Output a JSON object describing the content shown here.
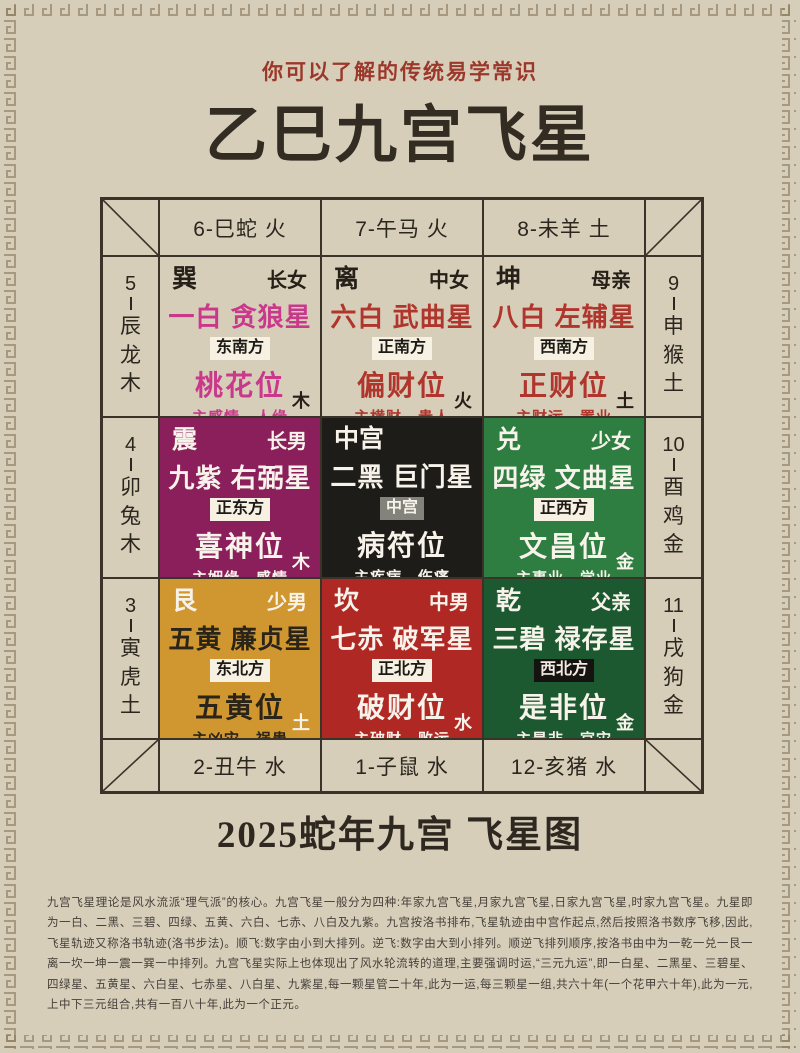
{
  "header": {
    "subtitle": "你可以了解的传统易学常识",
    "title": "乙巳九宫飞星"
  },
  "footer": {
    "caption": "2025蛇年九宫 飞星图",
    "paragraph": "九宫飞星理论是风水流派“理气派”的核心。九宫飞星一般分为四种:年家九宫飞星,月家九宫飞星,日家九宫飞星,时家九宫飞星。九星即为一白、二黑、三碧、四绿、五黄、六白、七赤、八白及九紫。九宫按洛书排布,飞星轨迹由中宫作起点,然后按照洛书数序飞移,因此,飞星轨迹又称洛书轨迹(洛书步法)。顺飞:数字由小到大排列。逆飞:数字由大到小排列。顺逆飞排列顺序,按洛书由中为一乾一兑一艮一离一坎一坤一震一巽一中排列。九宫飞星实际上也体现出了风水轮流转的道理,主要强调时运,“三元九运”,即一白星、二黑星、三碧星、四绿星、五黄星、六白星、七赤星、八白星、九紫星,每一颗星管二十年,此为一运,每三颗星一组,共六十年(一个花甲六十年),此为一元,上中下三元组合,共有一百八十年,此为一个正元。"
  },
  "palette": {
    "paper": "#d7ceba",
    "line": "#3a332a",
    "subtitle_red": "#9c382b",
    "title_ink": "#332c22",
    "meander": "#8d7c60"
  },
  "zodiac": {
    "top": [
      "6-巳蛇 火",
      "7-午马 火",
      "8-未羊 土"
    ],
    "bottom": [
      "2-丑牛 水",
      "1-子鼠 水",
      "12-亥猪 水"
    ],
    "left": [
      {
        "num": "5",
        "name": "辰龙木"
      },
      {
        "num": "4",
        "name": "卯兔木"
      },
      {
        "num": "3",
        "name": "寅虎土"
      }
    ],
    "right": [
      {
        "num": "9",
        "name": "申猴土"
      },
      {
        "num": "10",
        "name": "酉鸡金"
      },
      {
        "num": "11",
        "name": "戌狗金"
      }
    ]
  },
  "cells": [
    {
      "trigram": "巽",
      "relation": "长女",
      "star": "一白 贪狼星",
      "direction": "东南方",
      "position": "桃花位",
      "meaning": "主感情、人缘",
      "element": "木",
      "bg": "transparent",
      "header_fg": "#262019",
      "star_fg": "#c9388b",
      "badge_bg": "#f6f1e3",
      "badge_fg": "#1d1a15",
      "element_fg": "#262019"
    },
    {
      "trigram": "离",
      "relation": "中女",
      "star": "六白 武曲星",
      "direction": "正南方",
      "position": "偏财位",
      "meaning": "主横财、贵人",
      "element": "火",
      "bg": "transparent",
      "header_fg": "#262019",
      "star_fg": "#b0352c",
      "badge_bg": "#f6f1e3",
      "badge_fg": "#1d1a15",
      "element_fg": "#262019"
    },
    {
      "trigram": "坤",
      "relation": "母亲",
      "star": "八白 左辅星",
      "direction": "西南方",
      "position": "正财位",
      "meaning": "主财运、置业",
      "element": "土",
      "bg": "transparent",
      "header_fg": "#262019",
      "star_fg": "#b0352c",
      "badge_bg": "#f6f1e3",
      "badge_fg": "#1d1a15",
      "element_fg": "#262019"
    },
    {
      "trigram": "震",
      "relation": "长男",
      "star": "九紫 右弼星",
      "direction": "正东方",
      "position": "喜神位",
      "meaning": "主姻缘、感情",
      "element": "木",
      "bg": "#8a1f5b",
      "header_fg": "#f7f3ea",
      "star_fg": "#f7f3ea",
      "badge_bg": "#f6f1e3",
      "badge_fg": "#1d1a15",
      "element_fg": "#f7f3ea"
    },
    {
      "trigram": "中宫",
      "relation": "",
      "star": "二黑 巨门星",
      "direction": "中宫",
      "position": "病符位",
      "meaning": "主疾病、伤痛",
      "element": "",
      "bg": "#1e1c18",
      "header_fg": "#f7f3ea",
      "star_fg": "#f7f3ea",
      "badge_bg": "#84837b",
      "badge_fg": "#f7f3ea",
      "element_fg": "#f7f3ea"
    },
    {
      "trigram": "兑",
      "relation": "少女",
      "star": "四绿 文曲星",
      "direction": "正西方",
      "position": "文昌位",
      "meaning": "主事业、学业",
      "element": "金",
      "bg": "#2e7d41",
      "header_fg": "#f7f3ea",
      "star_fg": "#f7f3ea",
      "badge_bg": "#f6f1e3",
      "badge_fg": "#1d1a15",
      "element_fg": "#f7f3ea"
    },
    {
      "trigram": "艮",
      "relation": "少男",
      "star": "五黄 廉贞星",
      "direction": "东北方",
      "position": "五黄位",
      "meaning": "主凶灾、祸患",
      "element": "土",
      "bg": "#d0962f",
      "header_fg": "#f7f3ea",
      "star_fg": "#2a2419",
      "badge_bg": "#f6f1e3",
      "badge_fg": "#1d1a15",
      "element_fg": "#f7f3ea"
    },
    {
      "trigram": "坎",
      "relation": "中男",
      "star": "七赤 破军星",
      "direction": "正北方",
      "position": "破财位",
      "meaning": "主破财、败运",
      "element": "水",
      "bg": "#b02824",
      "header_fg": "#f7f3ea",
      "star_fg": "#f7f3ea",
      "badge_bg": "#f6f1e3",
      "badge_fg": "#1d1a15",
      "element_fg": "#f7f3ea"
    },
    {
      "trigram": "乾",
      "relation": "父亲",
      "star": "三碧 禄存星",
      "direction": "西北方",
      "position": "是非位",
      "meaning": "主是非、官灾",
      "element": "金",
      "bg": "#1d5930",
      "header_fg": "#f7f3ea",
      "star_fg": "#f7f3ea",
      "badge_bg": "#15130f",
      "badge_fg": "#f3e9e2",
      "element_fg": "#f7f3ea"
    }
  ]
}
